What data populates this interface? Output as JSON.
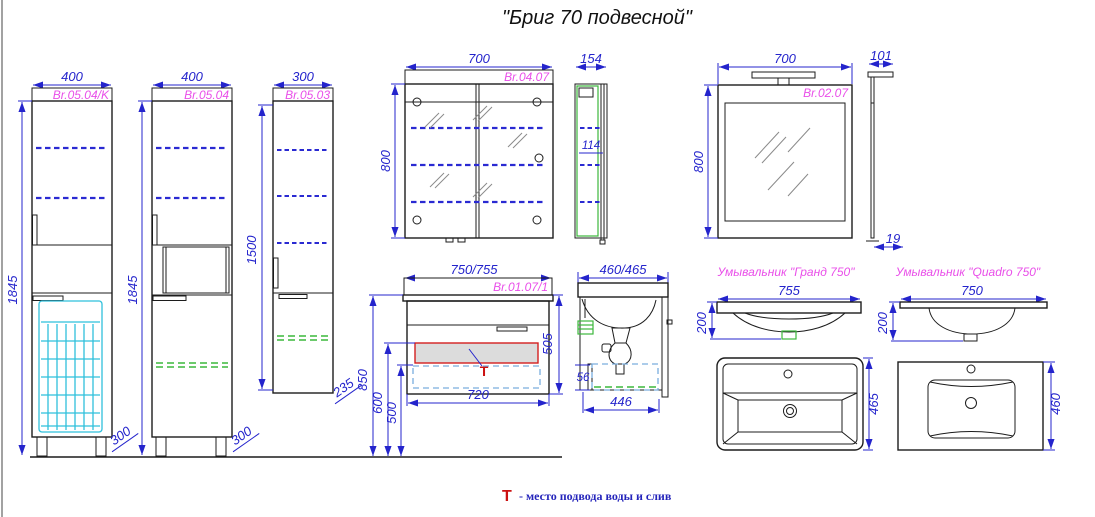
{
  "title": "\"Бриг 70 подвесной\"",
  "note": {
    "symbol": "Т",
    "text": "- место подвода воды и слив"
  },
  "colors": {
    "dimension_blue": "#2424cc",
    "label_magenta": "#e94fe9",
    "outline_black": "#1c1c1c",
    "accent_green": "#3cb83c",
    "basket_cyan": "#2fc0dc",
    "drawer_dash_blue": "#7aaede",
    "supply_red": "#d42020"
  },
  "tall_cabinet_k": {
    "code": "Br.05.04/K",
    "width": "400",
    "height": "1845",
    "depth": "300"
  },
  "tall_cabinet": {
    "code": "Br.05.04",
    "width": "400",
    "height": "1845",
    "depth": "300"
  },
  "half_cabinet": {
    "code": "Br.05.03",
    "width": "300",
    "height": "1500",
    "depth": "235"
  },
  "mirror_cabinet": {
    "code": "Br.04.07",
    "width": "700",
    "height": "800",
    "depth": "154",
    "inner_width": "114"
  },
  "mirror": {
    "code": "Br.02.07",
    "width": "700",
    "height": "800",
    "lamp_depth": "101",
    "thickness": "19"
  },
  "vanity": {
    "code": "Br.01.07/1",
    "width": "750/755",
    "height": "505",
    "mount_height": "850",
    "inlet_height": "600",
    "drain_height": "500",
    "body_width": "720",
    "depth": "460/465",
    "body_depth": "446",
    "drawer_side": "56"
  },
  "sink_grand": {
    "name": "Умывальник \"Гранд 750\"",
    "width": "755",
    "height": "200",
    "depth": "465"
  },
  "sink_quadro": {
    "name": "Умывальник \"Quadro 750\"",
    "width": "750",
    "height": "200",
    "depth": "460"
  }
}
